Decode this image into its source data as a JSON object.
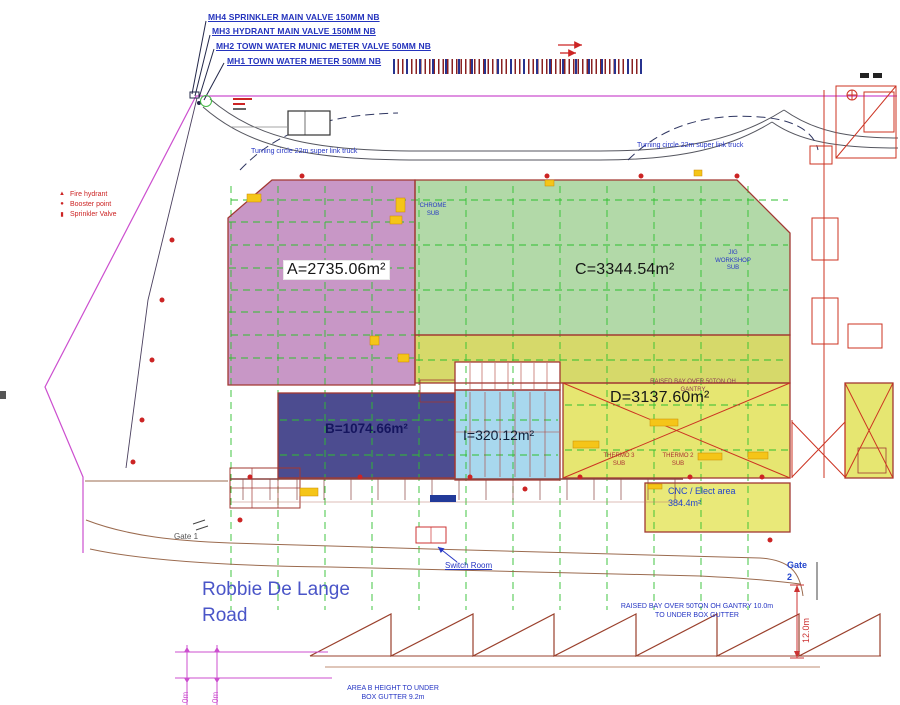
{
  "annotations": {
    "mh4": "MH4 SPRINKLER MAIN VALVE 150MM NB",
    "mh3": "MH3 HYDRANT MAIN VALVE 150MM NB",
    "mh2": "MH2 TOWN WATER MUNIC METER VALVE 50MM NB",
    "mh1": "MH1 TOWN WATER METER 50MM NB",
    "turning_left": "Turning circle 22m super link truck",
    "turning_right": "Turning circle 22m super link truck",
    "switch_room": "Switch Room",
    "gate1": "Gate 1",
    "gate2": "Gate\n2",
    "road_name": "Robbie De Lange\nRoad"
  },
  "legend": {
    "items": [
      {
        "glyph": "▲",
        "label": "Fire hydrant"
      },
      {
        "glyph": "●",
        "label": "Booster point"
      },
      {
        "glyph": "▮",
        "label": "Sprinkler Valve"
      }
    ]
  },
  "areas": {
    "a": {
      "label": "A=2735.06m²",
      "color": "#c897c6"
    },
    "b": {
      "label": "B=1074.66m²",
      "color": "#4c4c90"
    },
    "c": {
      "label": "C=3344.54m²",
      "color": "#b2d9a8"
    },
    "d": {
      "label": "D=3137.60m²",
      "color": "#e6e671"
    },
    "i": {
      "label": "I=320.12m²",
      "color": "#a8d8ee"
    },
    "strip": {
      "color": "#d6d96a"
    },
    "cnc": {
      "label": "CNC / Elect area\n384.4m²",
      "color": "#e9e979"
    },
    "annex": {
      "color": "#e6e671"
    }
  },
  "sub_labels": {
    "chrome": "CHROME\nSUB",
    "jig": "JIG\nWORKSHOP\nSUB",
    "thermo3": "THERMO 3\nSUB",
    "thermo2": "THERMO 2\nSUB",
    "raised_bay_d": "RAISED BAY OVER 50TON OH\nGANTRY"
  },
  "dimensions": {
    "raised_bay_bottom": "RAISED BAY OVER 50TON OH GANTRY 10.0m\nTO UNDER BOX GUTTER",
    "area_b_height": "AREA B HEIGHT TO UNDER\nBOX GUTTER 9.2m",
    "right_height": "12.0m",
    "left_dim_1": "0m",
    "left_dim_2": "0m"
  }
}
